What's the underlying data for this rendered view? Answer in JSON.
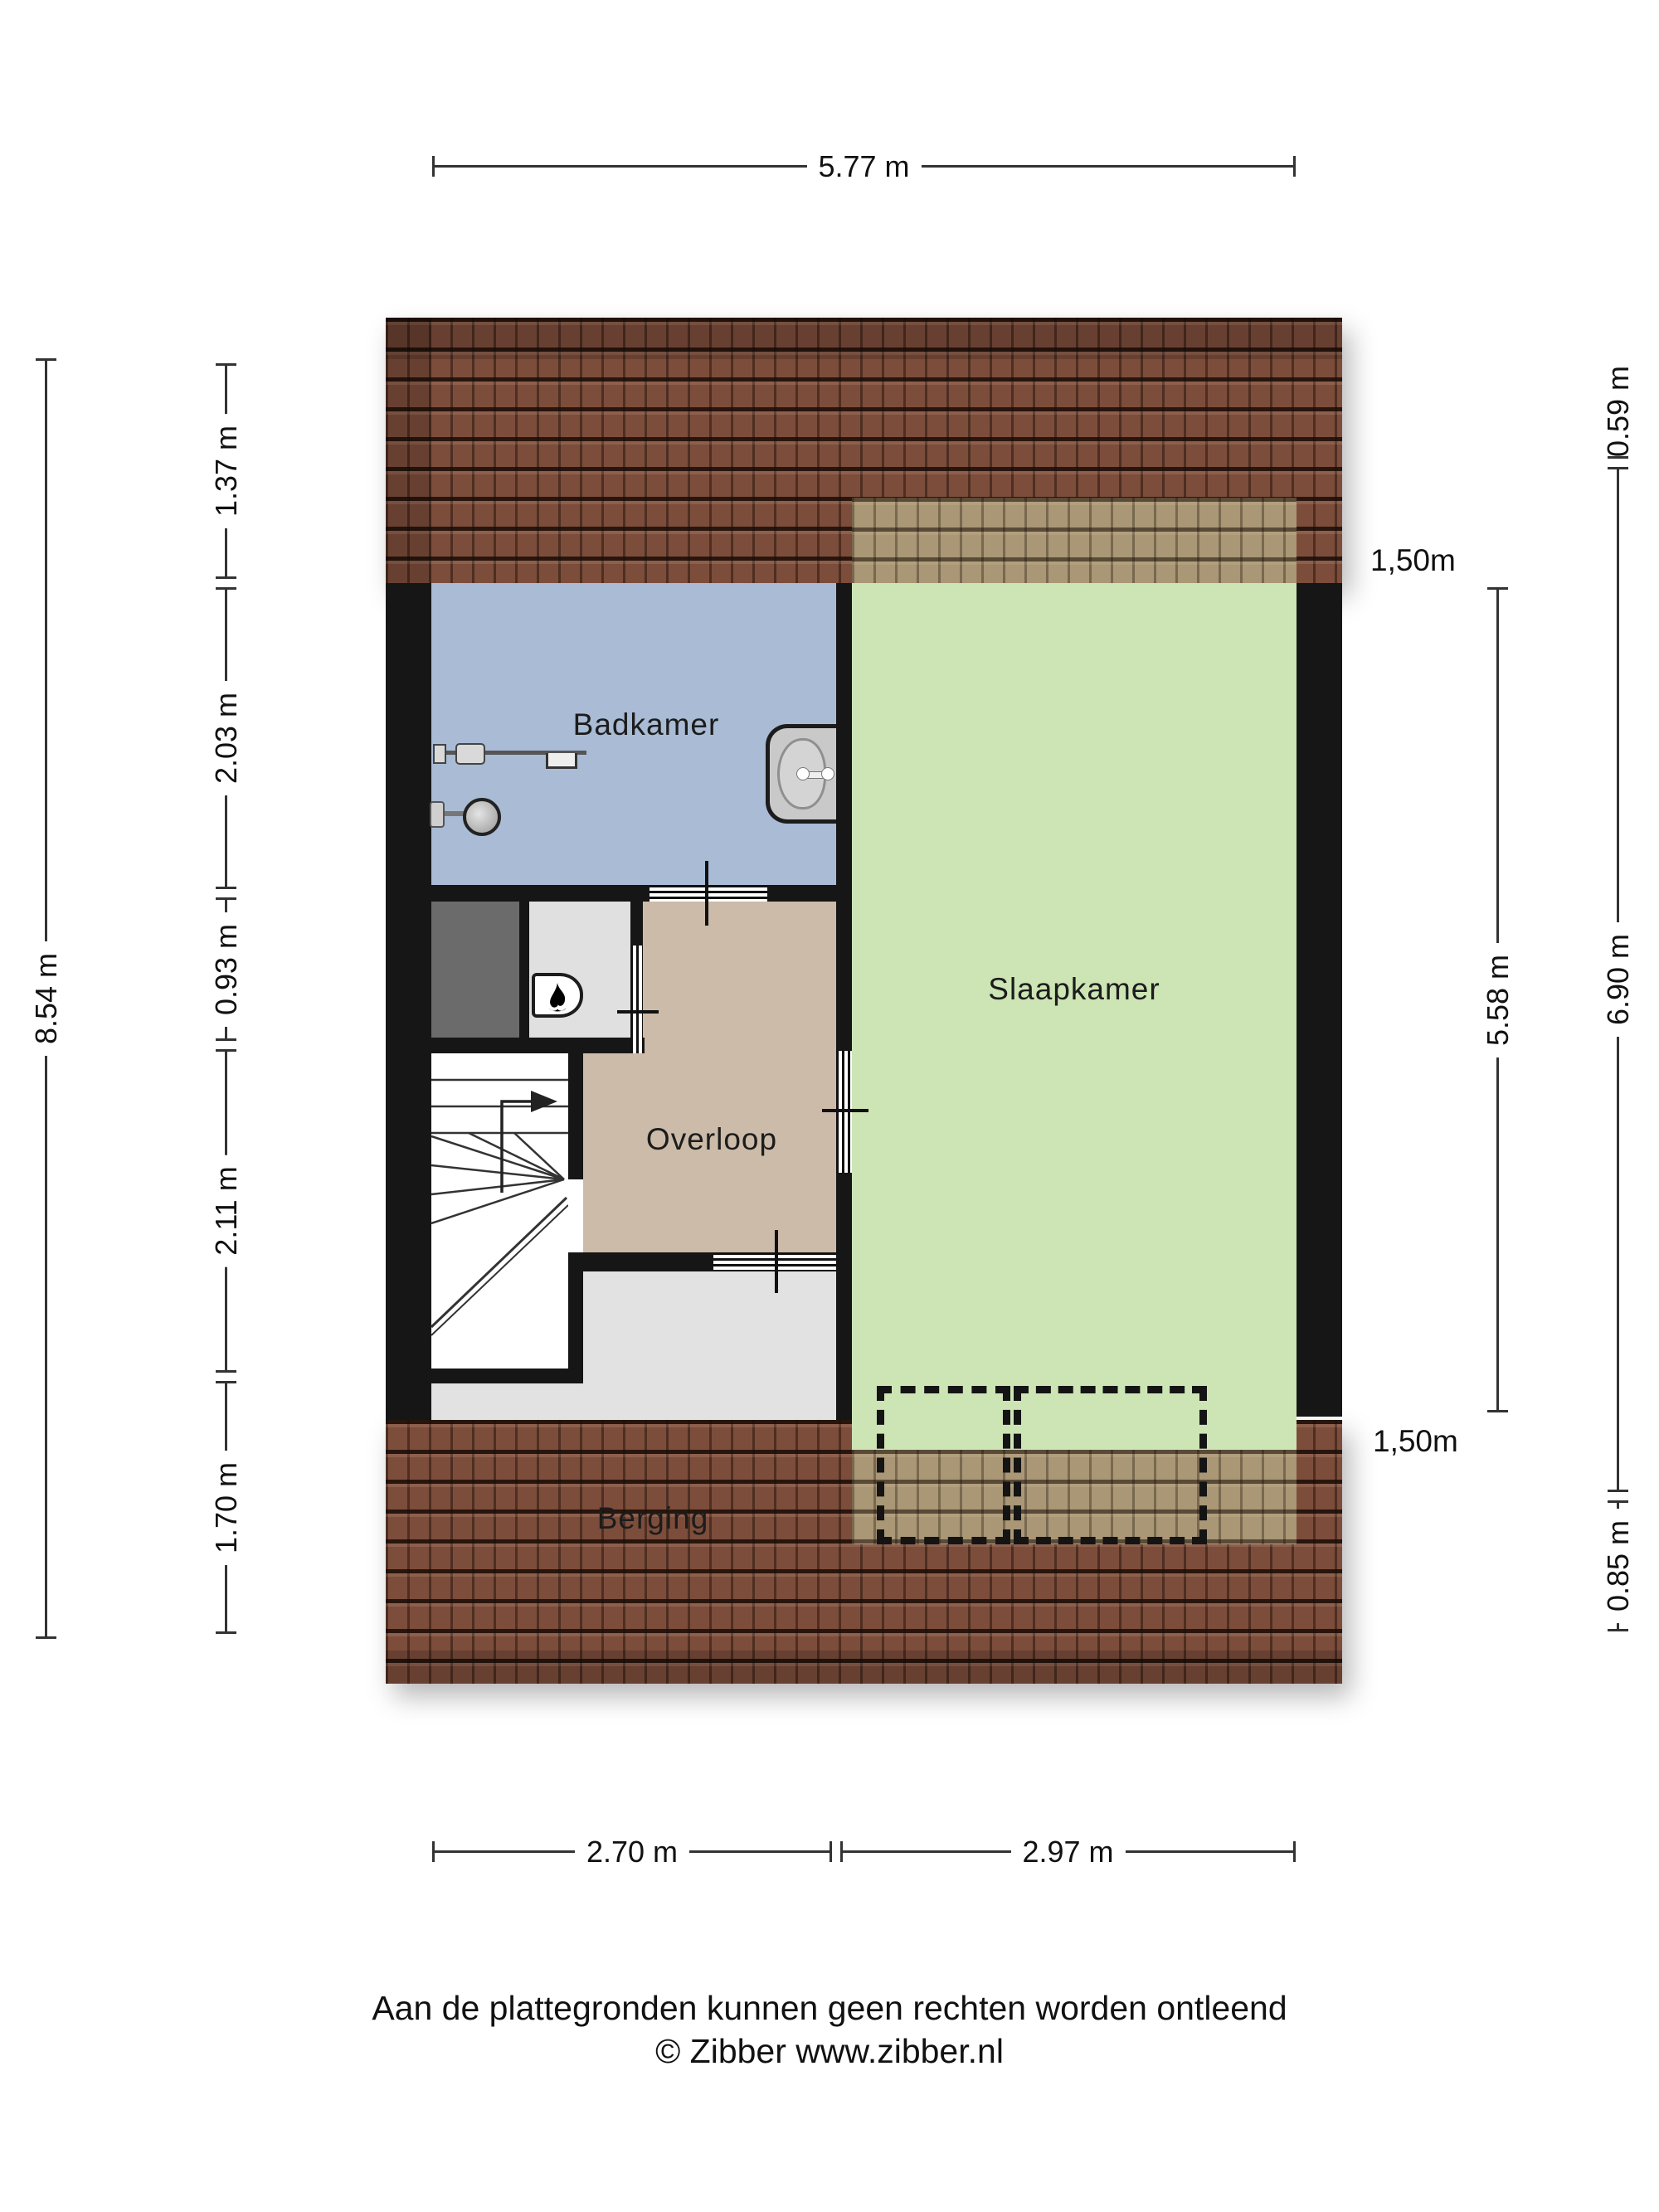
{
  "plan_type": "attic floor plan (Dutch)",
  "rooms": {
    "badkamer": {
      "label": "Badkamer",
      "color": "#a9bbd5"
    },
    "slaapkamer": {
      "label": "Slaapkamer",
      "color": "#cde4b4"
    },
    "overloop": {
      "label": "Overloop",
      "color": "#cbbba8"
    },
    "berging": {
      "label": "Berging",
      "color": "#e2e2e2"
    }
  },
  "dimensions": {
    "top": "5.77 m",
    "bottom_left": "2.70 m",
    "bottom_right": "2.97 m",
    "left_outer": "8.54 m",
    "left_inner": [
      "1.37 m",
      "2.03 m",
      "0.93 m",
      "2.11 m",
      "1.70 m"
    ],
    "right_inner": "5.58 m",
    "right_outer_top": "0.59 m",
    "right_outer_middle": "6.90 m",
    "right_outer_bottom": "0.85 m",
    "headroom_top": "1,50m",
    "headroom_bottom": "1,50m"
  },
  "footer": {
    "line1": "Aan de plattegronden kunnen geen rechten worden ontleend",
    "line2": "© Zibber www.zibber.nl"
  },
  "icons": {
    "shower": "shower-head-icon",
    "sink": "sink-icon",
    "boiler_flame": "boiler-flame-icon",
    "stairs_arrow": "stairs-up-arrow-icon"
  },
  "colors": {
    "wall": "#161616",
    "roof": "#7d4d3b",
    "dimension_lines": "#333333"
  }
}
